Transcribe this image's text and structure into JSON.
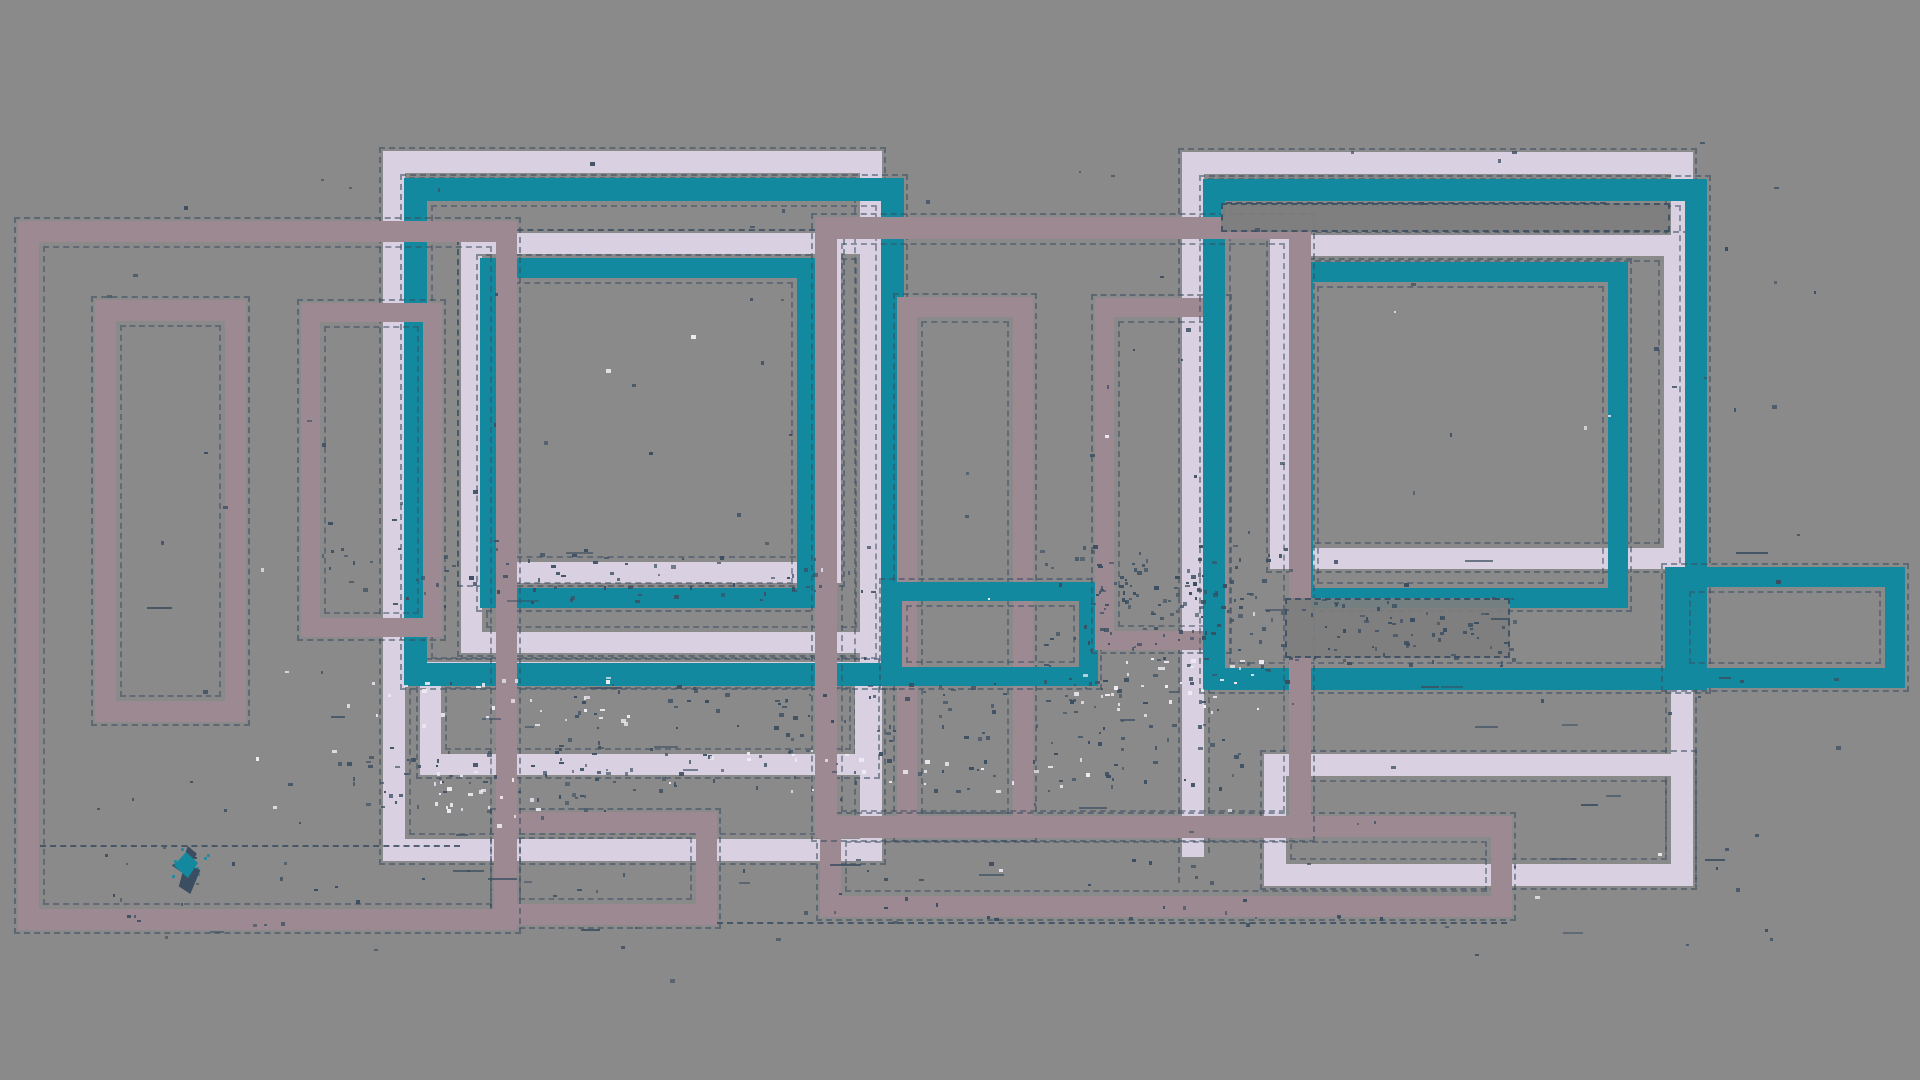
{
  "canvas": {
    "width": 1920,
    "height": 1080,
    "background": "#8a8a8a"
  },
  "palette": {
    "teal": "#12899f",
    "lavender": "#d9d1e1",
    "mauve": "#9c8992",
    "dark": "#3b4e61",
    "strip_gray": "#7e7e7e",
    "white": "#f0ebf3",
    "background": "#8a8a8a"
  },
  "rects": [
    {
      "name": "lavender-inner-frame-b",
      "x": 461,
      "y": 233,
      "w": 421,
      "h": 420,
      "bw": 21,
      "color": "lavender"
    },
    {
      "name": "lavender-inner-frame-a",
      "x": 461,
      "y": 233,
      "w": 380,
      "h": 350,
      "bw": 21,
      "color": "lavender"
    },
    {
      "name": "teal-inner-frame-center",
      "x": 480,
      "y": 258,
      "w": 337,
      "h": 350,
      "bw": 20,
      "color": "teal"
    },
    {
      "name": "lavender-center-big-frame",
      "x": 383,
      "y": 151,
      "w": 499,
      "h": 710,
      "bw": 22,
      "color": "lavender"
    },
    {
      "name": "lavender-center-low-frame",
      "x": 420,
      "y": 662,
      "w": 456,
      "h": 113,
      "bw": 21,
      "color": "lavender"
    },
    {
      "name": "teal-center-big-frame",
      "x": 404,
      "y": 178,
      "w": 500,
      "h": 508,
      "bw": 23,
      "color": "teal"
    },
    {
      "name": "mauve-middle-tall-frame",
      "x": 897,
      "y": 297,
      "w": 136,
      "h": 541,
      "bw": 20,
      "color": "mauve"
    },
    {
      "name": "teal-middle-small-frame",
      "x": 883,
      "y": 582,
      "w": 215,
      "h": 104,
      "bw": 19,
      "color": "teal"
    },
    {
      "name": "mauve-left-low-frame",
      "x": 494,
      "y": 812,
      "w": 223,
      "h": 113,
      "bw": 21,
      "color": "mauve"
    },
    {
      "name": "mauve-left-big-frame",
      "x": 18,
      "y": 221,
      "w": 499,
      "h": 709,
      "bw": 21,
      "color": "mauve"
    },
    {
      "name": "mauve-left-small-frame",
      "x": 95,
      "y": 300,
      "w": 151,
      "h": 422,
      "bw": 21,
      "color": "mauve"
    },
    {
      "name": "mauve-left-tall-frame",
      "x": 301,
      "y": 303,
      "w": 141,
      "h": 334,
      "bw": 19,
      "color": "mauve"
    },
    {
      "name": "lavender-right-big-frame",
      "x": 1182,
      "y": 152,
      "w": 511,
      "h": 705,
      "bw": 22,
      "color": "lavender",
      "open_bottom": true
    },
    {
      "name": "lavender-right-inner-frame",
      "x": 1270,
      "y": 235,
      "w": 415,
      "h": 334,
      "bw": 21,
      "color": "lavender"
    },
    {
      "name": "teal-right-inner-frame",
      "x": 1293,
      "y": 262,
      "w": 335,
      "h": 346,
      "bw": 20,
      "color": "teal"
    },
    {
      "name": "mauve-right-tall-frame",
      "x": 1095,
      "y": 298,
      "w": 133,
      "h": 352,
      "bw": 19,
      "color": "mauve"
    },
    {
      "name": "lavender-right-low-frame",
      "x": 1264,
      "y": 754,
      "w": 429,
      "h": 132,
      "bw": 22,
      "color": "lavender"
    },
    {
      "name": "mauve-right-low-frame",
      "x": 820,
      "y": 816,
      "w": 692,
      "h": 101,
      "bw": 21,
      "color": "mauve"
    },
    {
      "name": "teal-right-big-frame",
      "x": 1203,
      "y": 179,
      "w": 504,
      "h": 511,
      "bw": 22,
      "color": "teal"
    },
    {
      "name": "teal-right-ext-frame",
      "x": 1665,
      "y": 567,
      "w": 240,
      "h": 121,
      "bw": 20,
      "color": "teal"
    },
    {
      "name": "mauve-middle-big-frame",
      "x": 815,
      "y": 217,
      "w": 496,
      "h": 621,
      "bw": 22,
      "color": "mauve"
    }
  ],
  "strips": [
    {
      "name": "shadow-strip-top-right",
      "x": 1221,
      "y": 203,
      "w": 449,
      "h": 29,
      "color": "strip_gray"
    },
    {
      "name": "shadow-strip-mid-right",
      "x": 1285,
      "y": 598,
      "w": 225,
      "h": 60,
      "color": "strip_gray"
    }
  ],
  "dash_lines": [
    {
      "name": "stray-dash-line-bottom",
      "x": 717,
      "y": 922,
      "w": 790
    },
    {
      "name": "stray-dash-line-topright",
      "x": 1226,
      "y": 202,
      "w": 380
    },
    {
      "name": "stray-dash-line-left",
      "x": 40,
      "y": 845,
      "w": 420
    }
  ],
  "noise": {
    "seed": 42,
    "dark_clusters": [
      {
        "x": 320,
        "y": 545,
        "w": 560,
        "h": 60,
        "n": 70
      },
      {
        "x": 1040,
        "y": 545,
        "w": 250,
        "h": 140,
        "n": 110
      },
      {
        "x": 560,
        "y": 680,
        "w": 680,
        "h": 110,
        "n": 150
      },
      {
        "x": 1280,
        "y": 595,
        "w": 235,
        "h": 70,
        "n": 70
      },
      {
        "x": 80,
        "y": 855,
        "w": 1350,
        "h": 70,
        "n": 50
      },
      {
        "x": 330,
        "y": 745,
        "w": 280,
        "h": 70,
        "n": 60
      },
      {
        "x": 1090,
        "y": 560,
        "w": 140,
        "h": 50,
        "n": 40
      },
      {
        "x": 60,
        "y": 140,
        "w": 1800,
        "h": 840,
        "n": 140
      }
    ],
    "white_clusters": [
      {
        "x": 340,
        "y": 675,
        "w": 300,
        "h": 50,
        "n": 30
      },
      {
        "x": 1070,
        "y": 655,
        "w": 190,
        "h": 60,
        "n": 35
      },
      {
        "x": 430,
        "y": 770,
        "w": 110,
        "h": 55,
        "n": 22
      },
      {
        "x": 700,
        "y": 750,
        "w": 420,
        "h": 40,
        "n": 25
      },
      {
        "x": 200,
        "y": 300,
        "w": 1500,
        "h": 600,
        "n": 20
      }
    ],
    "dark_dashes": {
      "n": 35,
      "x": 80,
      "y": 540,
      "w": 1700,
      "h": 400
    },
    "teal_dots": {
      "x": 160,
      "y": 842,
      "w": 48,
      "h": 45,
      "n": 10
    }
  },
  "blob": {
    "name": "teal-leaf-blob",
    "x": 168,
    "y": 846,
    "w": 36,
    "h": 48,
    "clip": "polygon(55% 0%, 80% 16%, 64% 42%, 90% 50%, 62% 100%, 30% 84%, 40% 56%, 10% 40%, 42% 28%)",
    "color": "dark",
    "highlight": {
      "x": 174,
      "y": 852,
      "w": 24,
      "h": 26,
      "clip": "polygon(50% 0%, 100% 42%, 58% 100%, 0% 52%)",
      "color": "teal"
    }
  }
}
